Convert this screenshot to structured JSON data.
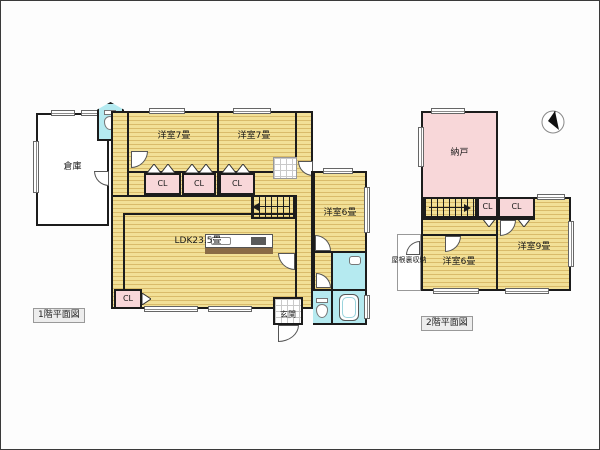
{
  "image": {
    "kind": "real-estate-floor-plan",
    "background": "#ffffff"
  },
  "colors": {
    "floor_yellow": "#f2e097",
    "floor_stripe": "#d9bb6a",
    "closet_pink": "#f8d7d9",
    "storage_pink": "#f8d7d9",
    "wet_area_cyan": "#b5eaf0",
    "wall_black": "#1c1c1c"
  },
  "floor1": {
    "caption": "1階平面図",
    "rooms": {
      "souko": "倉庫",
      "bedroom_a": "洋室7畳",
      "bedroom_b": "洋室7畳",
      "closet1": "CL",
      "closet2": "CL",
      "closet3": "CL",
      "ldk": "LDK23.5畳",
      "closet4": "CL",
      "bedroom_c": "洋室6畳",
      "genkan": "玄関"
    }
  },
  "floor2": {
    "caption": "2階平面図",
    "rooms": {
      "nando": "納戸",
      "closet1": "CL",
      "closet2": "CL",
      "attic": "屋根裏収納",
      "bedroom_a": "洋室6畳",
      "bedroom_b": "洋室9畳"
    }
  }
}
